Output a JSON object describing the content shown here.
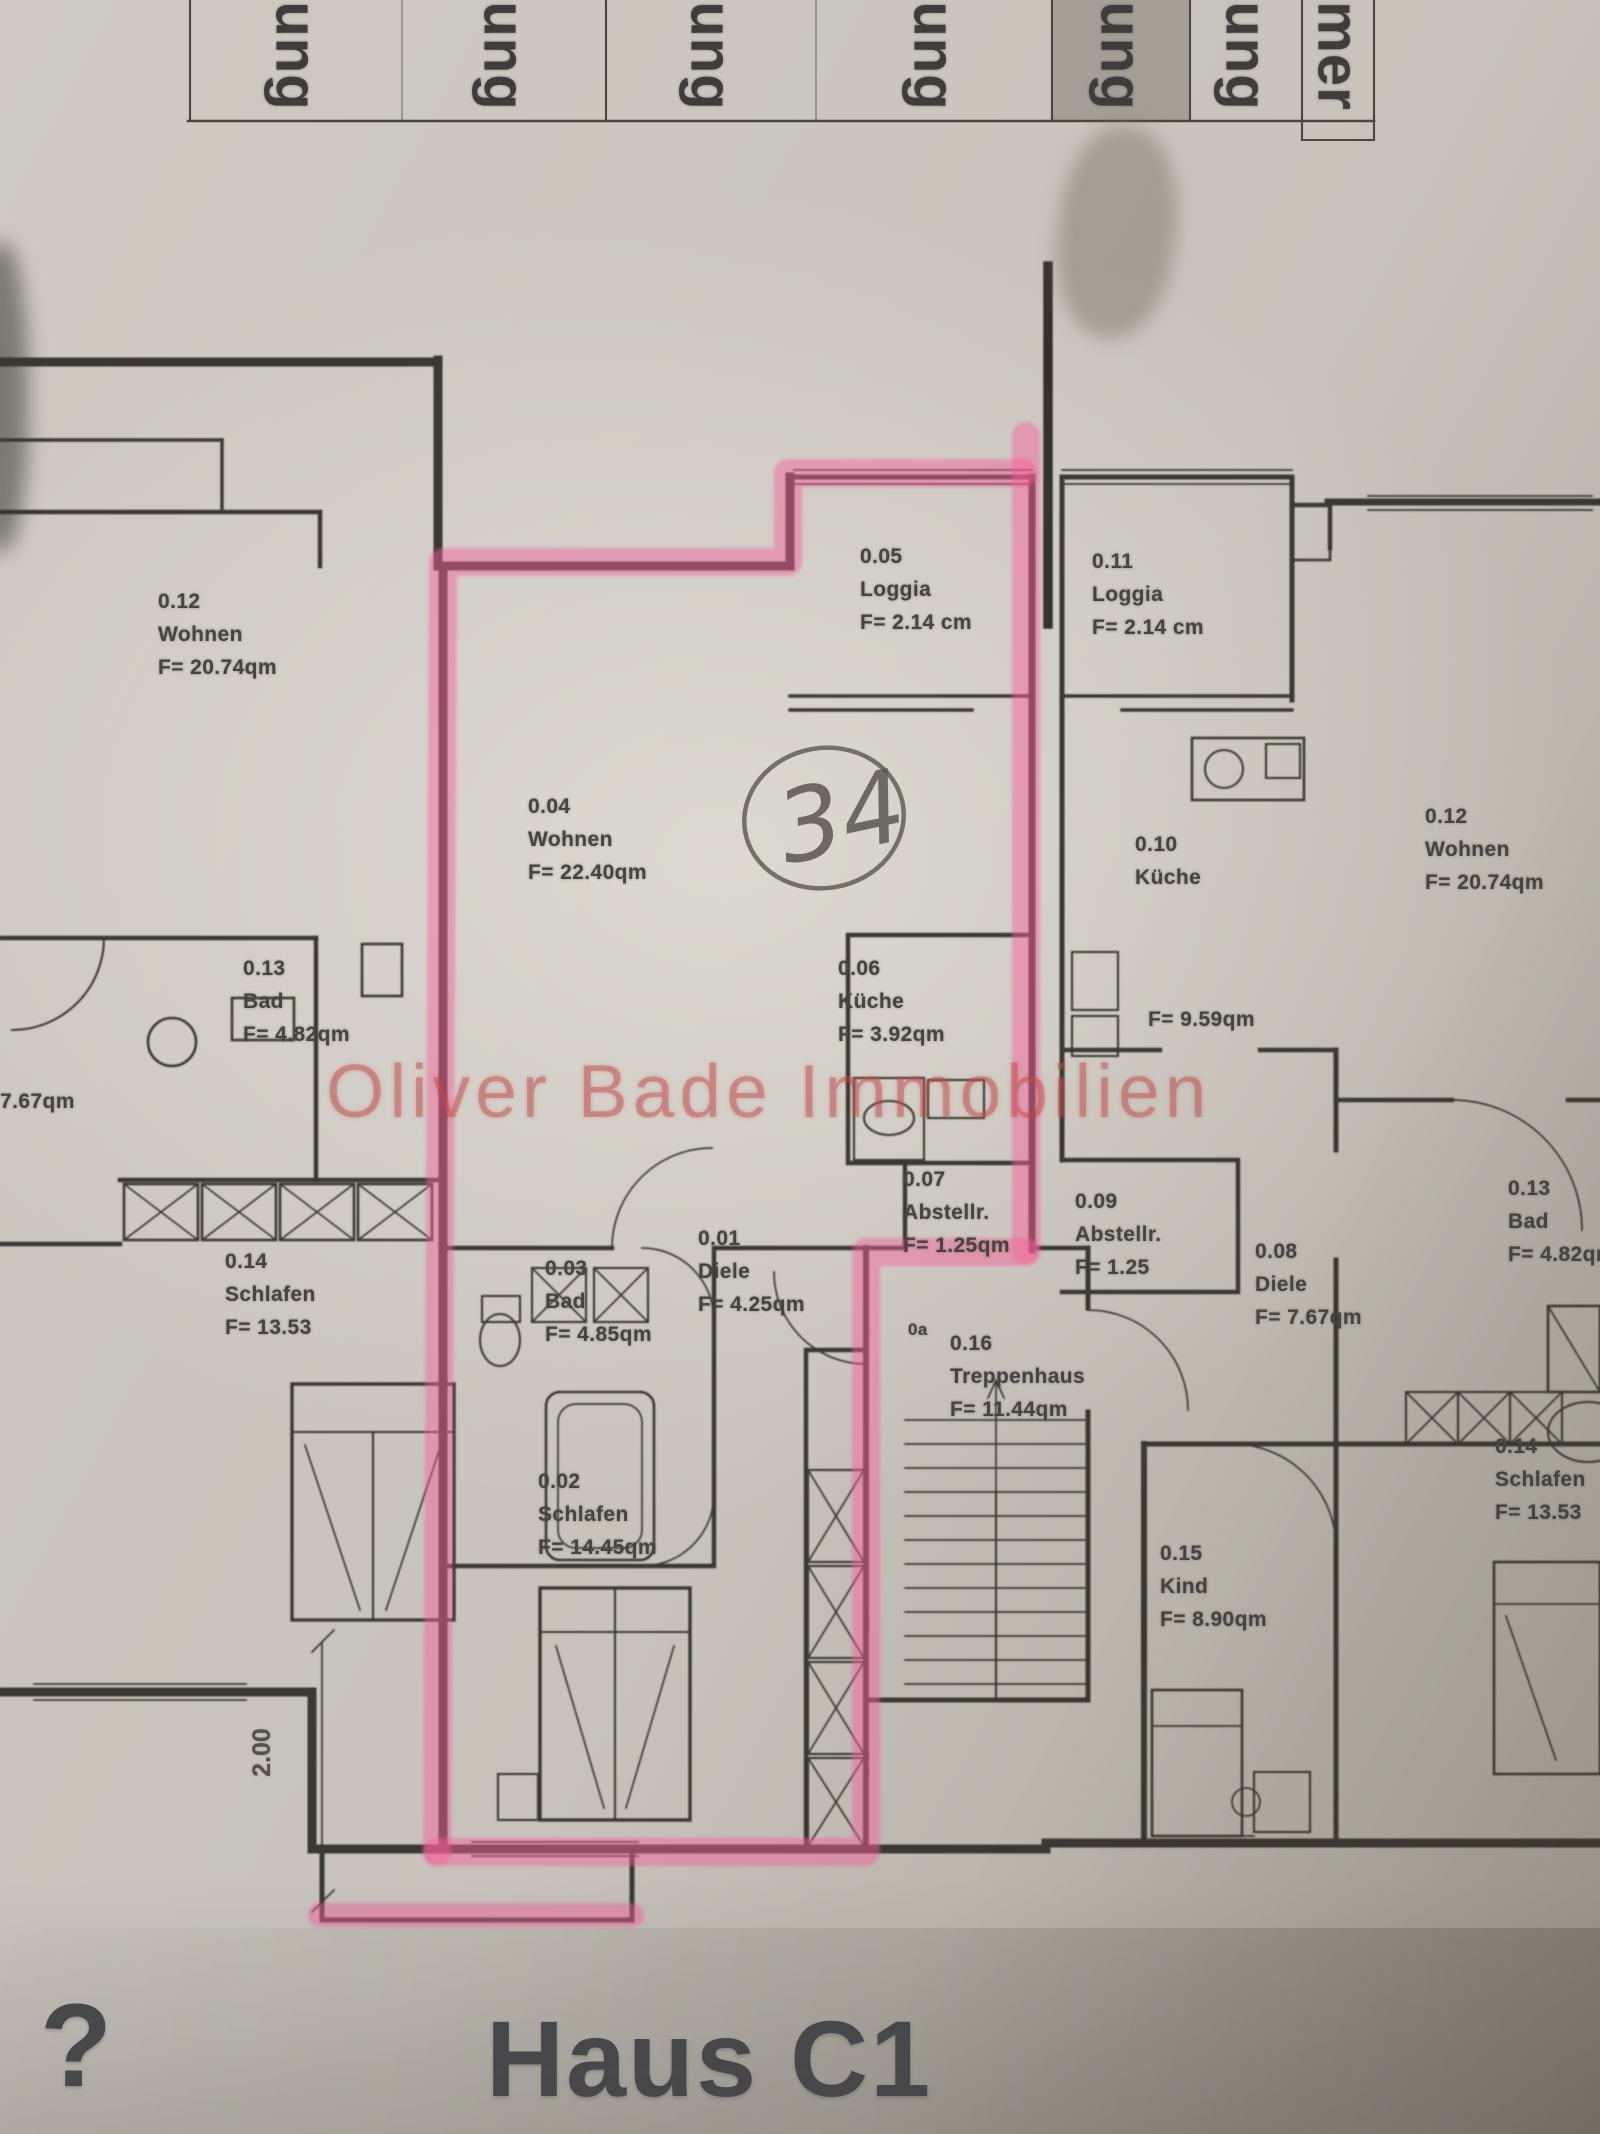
{
  "colors": {
    "highlight-pink": "rgba(244,95,155,0.48)",
    "marker-gray": "rgba(125,119,110,0.5)",
    "watermark-red": "rgba(192,74,70,0.42)",
    "ink": "#3b3833",
    "pen": "#26241f"
  },
  "header_table": {
    "columns": [
      {
        "label": "ung",
        "highlighted": false,
        "x": 190,
        "w": 212
      },
      {
        "label": "ung",
        "highlighted": false,
        "x": 402,
        "w": 204
      },
      {
        "label": "ung",
        "highlighted": false,
        "x": 606,
        "w": 210
      },
      {
        "label": "ung",
        "highlighted": false,
        "x": 816,
        "w": 236
      },
      {
        "label": "ung",
        "highlighted": true,
        "x": 1052,
        "w": 138
      },
      {
        "label": "ung",
        "highlighted": false,
        "x": 1190,
        "w": 112
      },
      {
        "label": "mer",
        "highlighted": false,
        "x": 1302,
        "w": 72
      }
    ]
  },
  "plan": {
    "rooms": [
      {
        "id": "0.12",
        "name": "Wohnen",
        "area": "F= 20.74qm",
        "x": 158,
        "y": 585
      },
      {
        "id": "0.04",
        "name": "Wohnen",
        "area": "F= 22.40qm",
        "x": 528,
        "y": 790
      },
      {
        "id": "0.05",
        "name": "Loggia",
        "area": "F= 2.14 cm",
        "x": 860,
        "y": 540
      },
      {
        "id": "0.11",
        "name": "Loggia",
        "area": "F= 2.14 cm",
        "x": 1092,
        "y": 545
      },
      {
        "id": "0.10",
        "name": "Küche",
        "area": "",
        "x": 1135,
        "y": 828
      },
      {
        "id": "0.12",
        "name": "Wohnen",
        "area": "F= 20.74qm",
        "x": 1425,
        "y": 800
      },
      {
        "id": "0.13",
        "name": "Bad",
        "area": "F= 4.82qm",
        "x": 243,
        "y": 952
      },
      {
        "id": "0.06",
        "name": "Küche",
        "area": "F= 3.92qm",
        "x": 838,
        "y": 952
      },
      {
        "id": "0.07",
        "name": "Abstellr.",
        "area": "F= 1.25qm",
        "x": 903,
        "y": 1163
      },
      {
        "id": "0.09",
        "name": "Abstellr.",
        "area": "F= 1.25",
        "x": 1075,
        "y": 1185
      },
      {
        "id": "0.01",
        "name": "Diele",
        "area": "F= 4.25qm",
        "x": 698,
        "y": 1222
      },
      {
        "id": "0.03",
        "name": "Bad",
        "area": "F= 4.85qm",
        "x": 545,
        "y": 1252
      },
      {
        "id": "0.08",
        "name": "Diele",
        "area": "F= 7.67qm",
        "x": 1255,
        "y": 1235
      },
      {
        "id": "0.13",
        "name": "Bad",
        "area": "F= 4.82qm",
        "x": 1508,
        "y": 1172
      },
      {
        "id": "0.14",
        "name": "Schlafen",
        "area": "F= 13.53",
        "x": 225,
        "y": 1245
      },
      {
        "id": "0.16",
        "name": "Treppenhaus",
        "area": "F= 11.44qm",
        "x": 950,
        "y": 1327
      },
      {
        "id": "0.02",
        "name": "Schlafen",
        "area": "F= 14.45qm",
        "x": 538,
        "y": 1465
      },
      {
        "id": "0.15",
        "name": "Kind",
        "area": "F= 8.90qm",
        "x": 1160,
        "y": 1537
      },
      {
        "id": "0.14",
        "name": "Schlafen",
        "area": "F= 13.53",
        "x": 1495,
        "y": 1430
      }
    ],
    "texts": [
      {
        "text": "F= 9.59qm",
        "x": 1148,
        "y": 1008,
        "small": false
      },
      {
        "text": "7.67qm",
        "x": 0,
        "y": 1090,
        "small": false
      },
      {
        "text": "0a",
        "x": 908,
        "y": 1320,
        "small": true
      }
    ],
    "dimension_label": "2.00",
    "handwritten_note": "34"
  },
  "watermark": "Oliver Bade Immobilien",
  "footer": {
    "title": "Haus C1",
    "corner_mark": "?"
  }
}
